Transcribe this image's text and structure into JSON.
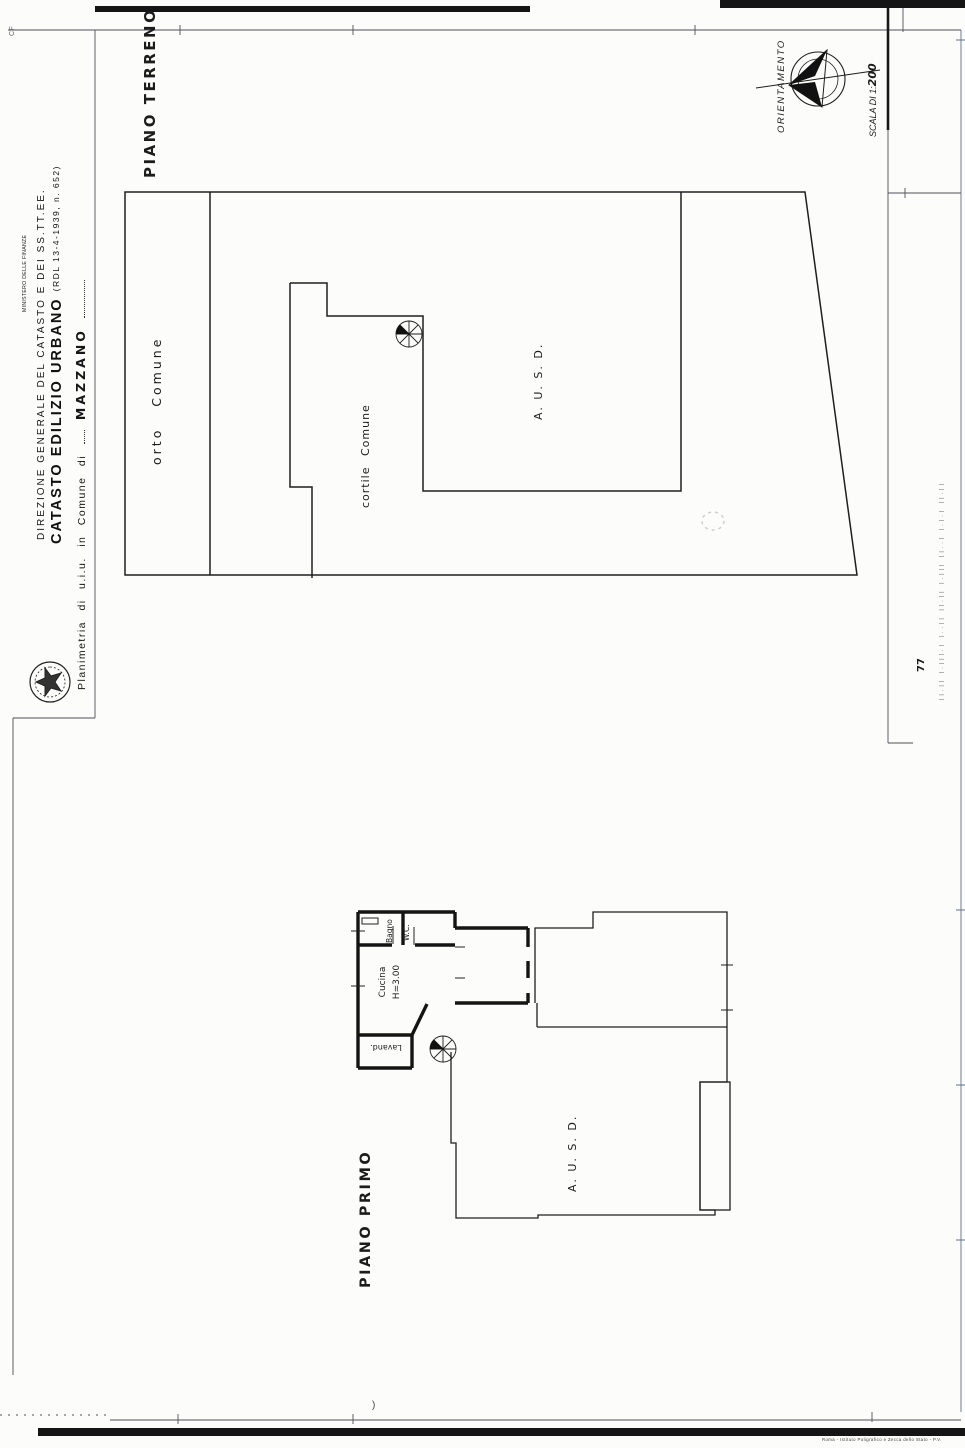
{
  "page": {
    "corner_mark": "CF",
    "sheet_number": "77",
    "edge_marks": "||.|| |.|||.| |..|| ||.|| |.||| ||..| |.|.| ||.||",
    "printer_imprint": "Roma - Istituto Poligrafico e Zecca dello Stato - P.V.",
    "paren_mark": ")"
  },
  "header": {
    "ministry_small": "MINISTERO DELLE FINANZE",
    "direzione": "DIREZIONE GENERALE DEL CATASTO E DEI SS.TT.EE.",
    "catasto_bold": "CATASTO EDILIZIO URBANO",
    "catasto_ref": "(RDL 13-4-1939, n. 652)",
    "planimetria_prefix": "Planimetria di u.i.u. in Comune di",
    "comune_name": "MAZZANO"
  },
  "orientation": {
    "label": "ORIENTAMENTO",
    "scale_prefix": "SCALA DI 1:",
    "scale_value": "200"
  },
  "ground_floor": {
    "title": "PIANO TERRENO",
    "orto_label": "orto Comune",
    "cortile_label": "cortile Comune",
    "ausd_label": "A. U. S. D."
  },
  "first_floor": {
    "title": "PIANO PRIMO",
    "bagno_label": "Bagno",
    "wc_label": "W.C.",
    "cucina_label": "Cucina",
    "cucina_height": "H=3.00",
    "lavand_label": "Lavand.",
    "ausd_label": "A. U. S. D."
  }
}
